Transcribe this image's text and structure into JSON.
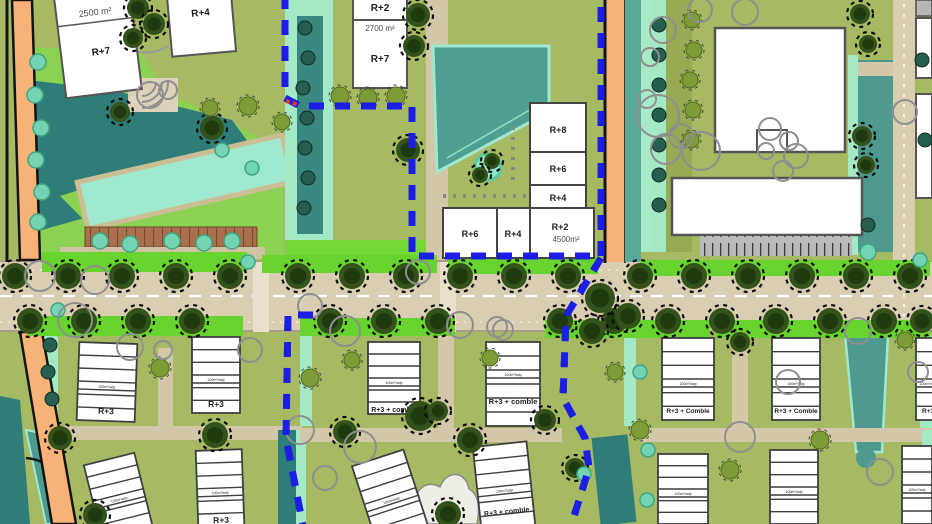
{
  "buildings": {
    "tl_area": "2500 m²",
    "tl_main": "R+7",
    "tl_side": "R+4",
    "tm_top": "R+2",
    "tm_top_area": "2700 m²",
    "tm_main": "R+7",
    "stack_1": "R+8",
    "stack_2": "R+6",
    "stack_3": "R+4",
    "row_1": "R+6",
    "row_2": "R+4",
    "row_3": "R+2",
    "row_3_area": "4500m²",
    "bl_1": "R+3",
    "bl_2": "R+3",
    "bl_3": "R+3",
    "bm_1": "R+3 + comble",
    "bm_2": "R+3 + comble",
    "bm_3": "R+3 + comble",
    "br_1": "R+3 + Comble",
    "br_2": "R+3 + Comble",
    "br_3": "R+3",
    "unit_band": "100m²/adp"
  },
  "colors": {
    "boundary_blue": "#1d1de8",
    "road_orange": "#f7b377",
    "road_tan": "#d9cdb2",
    "water_dark": "#2f7d78",
    "water_teal": "#4f9a8e",
    "pool_mint": "#9fe9cf",
    "block_olive": "#a6ba64",
    "verge_green": "#67d42f",
    "park_green": "#8bd152"
  }
}
